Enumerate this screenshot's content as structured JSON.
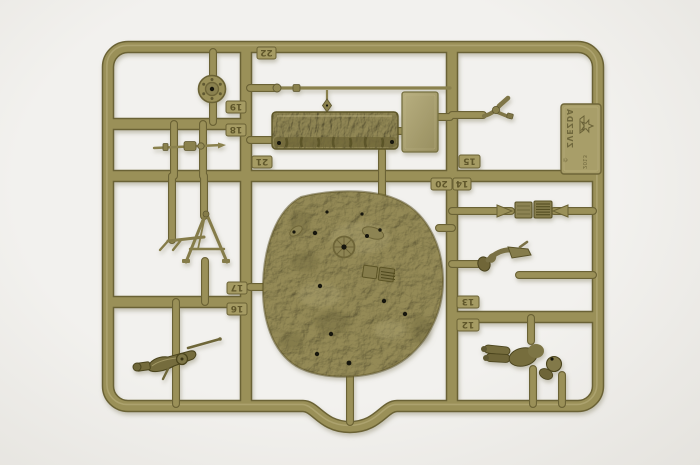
{
  "scene": {
    "description": "photograph of an olive-green injection-molded model kit sprue with numbered parts and a large textured terrain base, on a white background",
    "colors": {
      "bg": "#f2f1ee",
      "bg_edge": "#e5e3de",
      "runner": "#9a9058",
      "runner_dark": "#6b6234",
      "runner_light": "#c3b98a",
      "part": "#80774a",
      "part_dark": "#4c451f",
      "tab_fill": "#a59b64",
      "tab_text": "#5f572c",
      "base_fill": "#948a56",
      "base_dark": "#57501f",
      "panel_light": "#b5ac7d",
      "hole": "#17130a"
    }
  },
  "brand_tag": {
    "text": "ZVEZDA",
    "year": "2013",
    "copyright_symbol": "©",
    "logo": "zvezda-star-icon"
  },
  "part_tabs": [
    {
      "number": "22"
    },
    {
      "number": "19"
    },
    {
      "number": "18"
    },
    {
      "number": "21"
    },
    {
      "number": "15"
    },
    {
      "number": "20"
    },
    {
      "number": "14"
    },
    {
      "number": "17"
    },
    {
      "number": "16"
    },
    {
      "number": "13"
    },
    {
      "number": "12"
    }
  ],
  "parts": [
    "road-wheel",
    "cleaning-rod",
    "log-beam",
    "long-rod",
    "flat-panel",
    "periscope-fork",
    "engine-grille",
    "bent-arm",
    "terrain-base",
    "tripod-mount",
    "machine-gun",
    "soldier-figure"
  ]
}
